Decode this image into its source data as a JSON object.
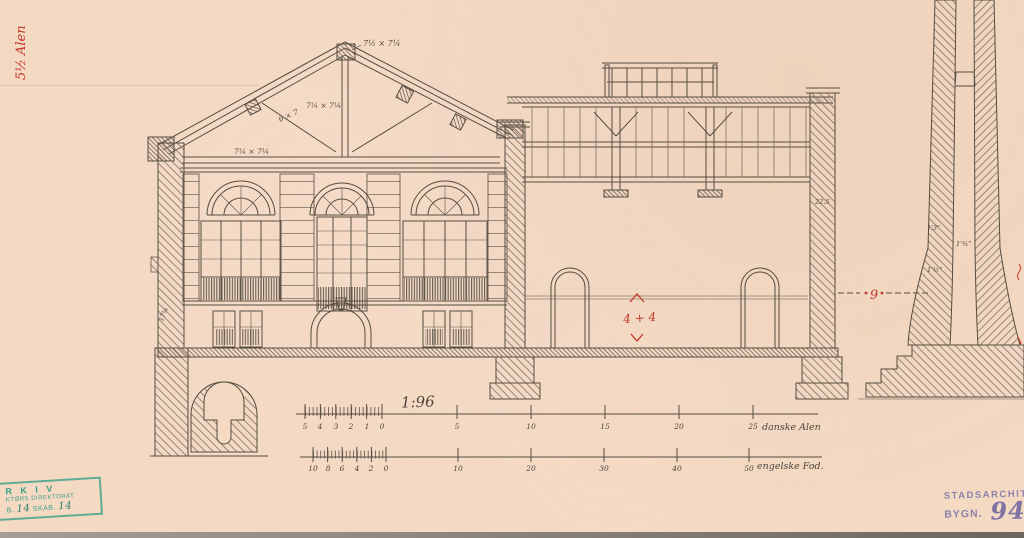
{
  "annotations": {
    "margin_note": "5½ Alen",
    "timber": {
      "ridge": "7½ × 7¼",
      "king_post": "7¼ × 7¼",
      "strut": "6 × 7",
      "tie_beam": "7¼ × 7¼"
    },
    "masonry": {
      "right_wall": "22.5",
      "left_foundation": "17¼",
      "chimney_top": "1'3\"",
      "chimney_flue": "1'¾\"",
      "chimney_mid": "1'½\""
    },
    "red": {
      "dimension": "4 + 4",
      "datum": "9"
    }
  },
  "scale_bars": {
    "ratio": "1:96",
    "alen": {
      "unit": "danske Alen",
      "left": [
        "5",
        "4",
        "3",
        "2",
        "1",
        "0"
      ],
      "right": [
        "5",
        "10",
        "15",
        "20",
        "25"
      ]
    },
    "fod": {
      "unit": "engelske Fod.",
      "left": [
        "10",
        "8",
        "6",
        "4",
        "2",
        "0"
      ],
      "right": [
        "10",
        "20",
        "30",
        "40",
        "50"
      ]
    }
  },
  "stamps": {
    "archive": {
      "line1": "R K I V",
      "line2": "KTØRS DIREKTORAT",
      "line3_prefix": "B.",
      "line3_value1": "14",
      "line3_mid": "SKAB.",
      "line3_value2": "14"
    },
    "city_architect": {
      "line1": "STADSARCHITE",
      "line2_prefix": "BYGN.",
      "line2_value": "94"
    }
  },
  "colors": {
    "paper": "#f4d9c3",
    "ink": "#564c41",
    "red_annotation": "#c23527",
    "stamp_green": "#2d9c85",
    "stamp_purple": "#8278a8"
  }
}
